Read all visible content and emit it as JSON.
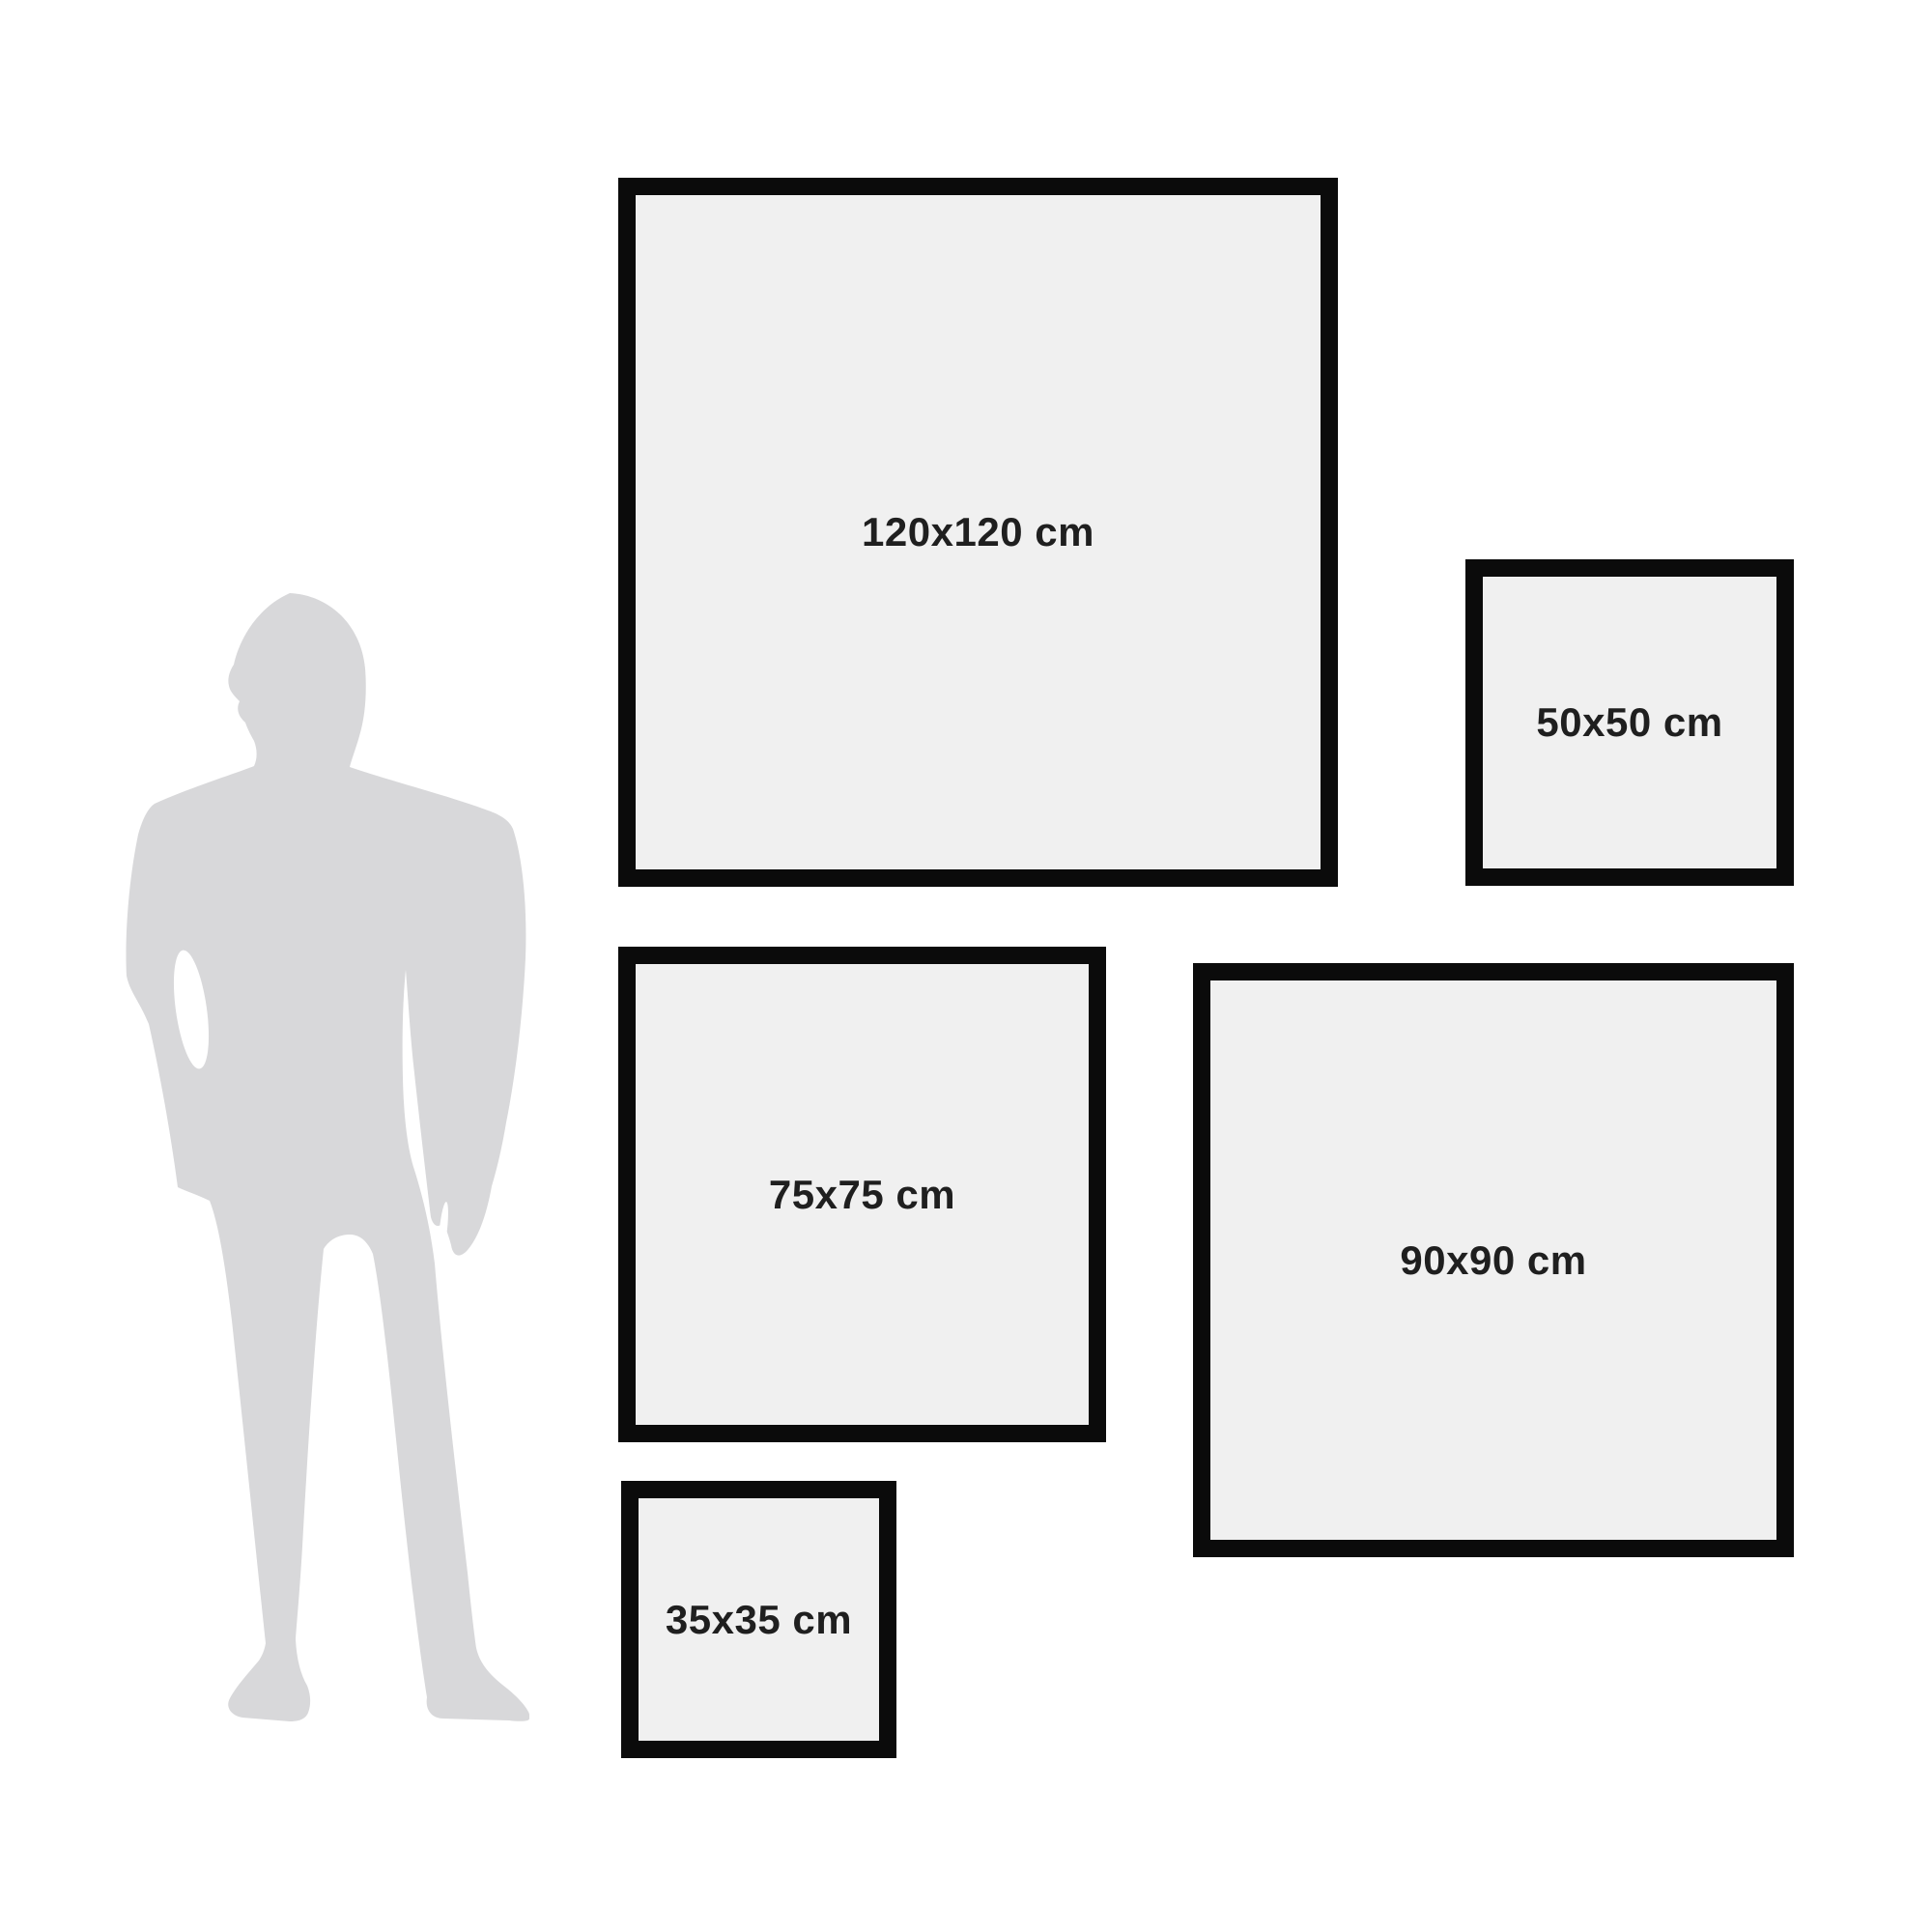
{
  "diagram": {
    "kind": "wall-art-size-comparison",
    "unit": "cm"
  },
  "frames": [
    {
      "id": "120x120",
      "label": "120x120 cm"
    },
    {
      "id": "50x50",
      "label": "50x50 cm"
    },
    {
      "id": "75x75",
      "label": "75x75 cm"
    },
    {
      "id": "90x90",
      "label": "90x90 cm"
    },
    {
      "id": "35x35",
      "label": "35x35 cm"
    }
  ],
  "figure": {
    "icon": "man-silhouette-icon",
    "description": "standing man silhouette for scale"
  },
  "colors": {
    "background": "#ffffff",
    "frame_fill": "#f0f0f0",
    "frame_border": "#0b0b0b",
    "label_text": "#1f1f1f",
    "silhouette": "#d8d8da"
  }
}
